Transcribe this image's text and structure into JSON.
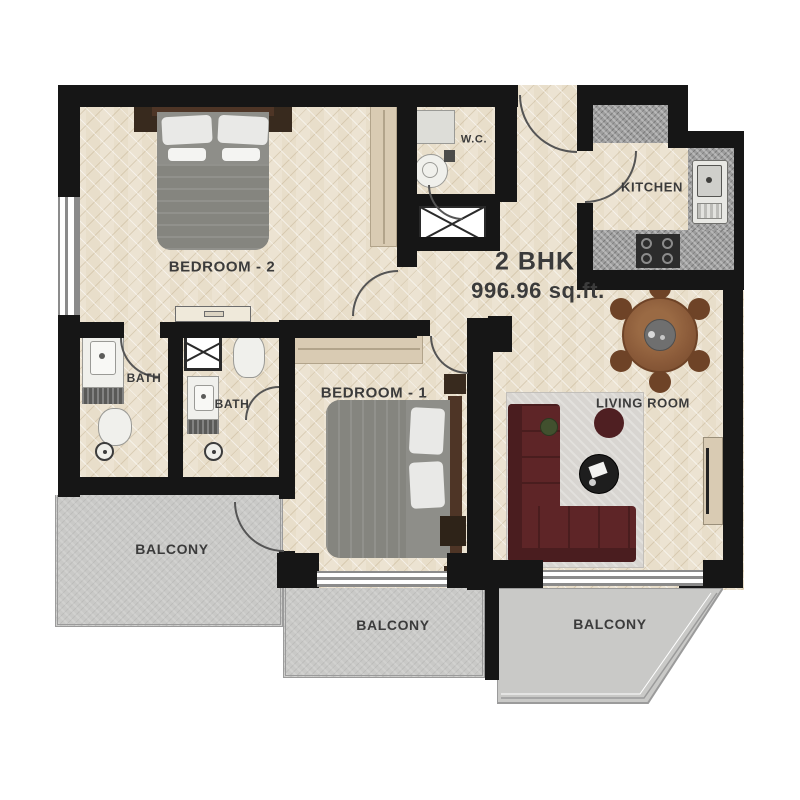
{
  "plan": {
    "unit_type": "2 BHK",
    "unit_area": "996.96 sq.ft.",
    "labels": {
      "bedroom2": "BEDROOM - 2",
      "bedroom1": "BEDROOM - 1",
      "wc": "W.C.",
      "kitchen": "KITCHEN",
      "living_room": "LIVING ROOM",
      "bath1": "BATH",
      "bath2": "BATH",
      "balcony_left": "BALCONY",
      "balcony_middle": "BALCONY",
      "balcony_right": "BALCONY"
    },
    "colors": {
      "wall": "#161616",
      "floor": "#ece3d2",
      "balcony": "#c9c9c7",
      "railing": "#9b9b9b",
      "granite": "#9d9d9d",
      "sofa": "#5e2527",
      "rug": "#d8d5d1",
      "wood": "#8a5a39",
      "bed": "#8e8e89",
      "pillow": "#e9e9e7",
      "headboard": "#4e3526",
      "wardrobe": "#d9cbb3",
      "text": "#3b3b3b"
    }
  }
}
